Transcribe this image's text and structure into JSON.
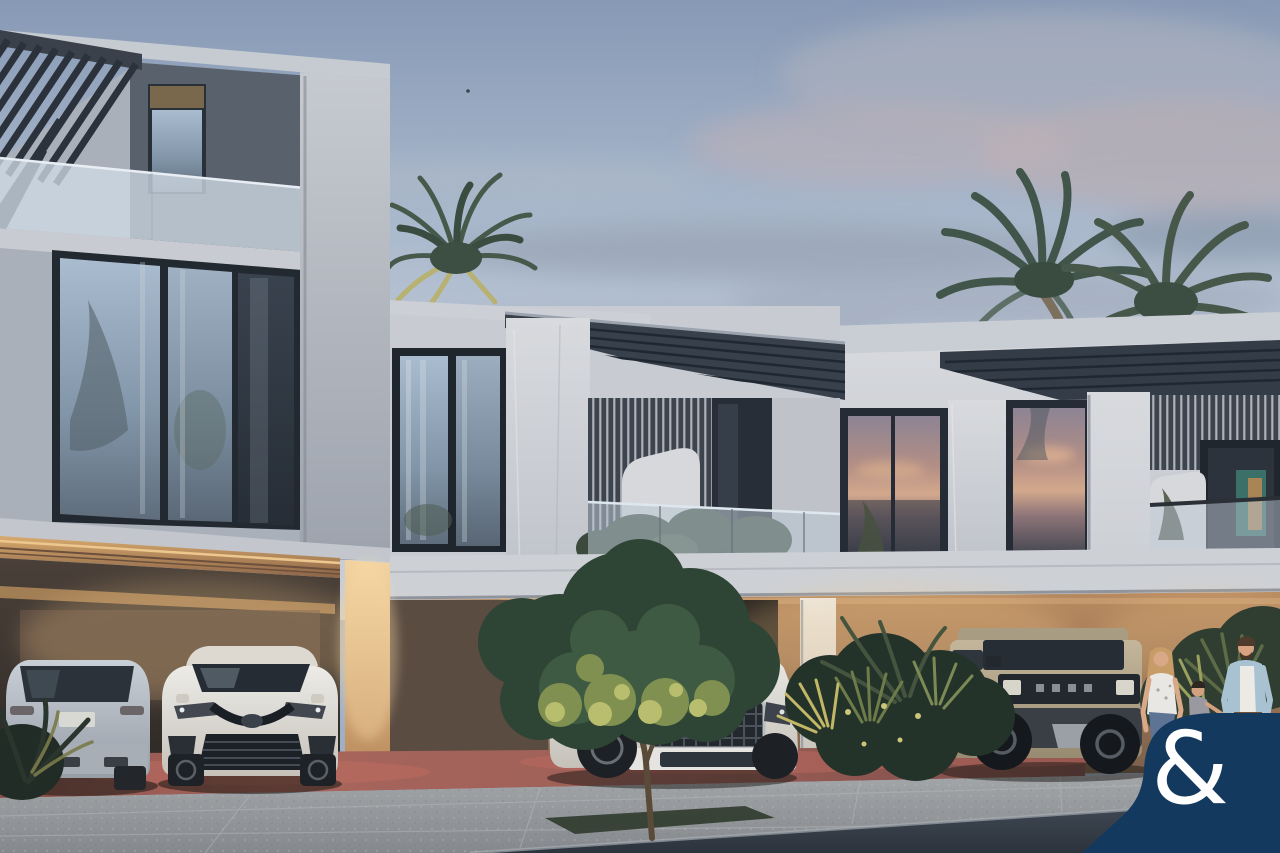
{
  "watermark": {
    "symbol": "&",
    "background_color": "#14395e",
    "symbol_color": "#ffffff"
  },
  "palette": {
    "sky_top": "#8799b5",
    "sky_horizon": "#c8cdd6",
    "cloud_grey": "#9aa5b6",
    "cloud_pink": "#c2b2b6",
    "facade_light": "#c6cad0",
    "facade_white": "#d6d8dc",
    "facade_dark_panel": "#59616d",
    "window_frame": "#20262e",
    "roof_canopy_dark": "#38404c",
    "glass_reflection": "#b9c6d2",
    "sunset_reflection": "#d3a88c",
    "warm_light": "#f0cc96",
    "warm_wall": "#a87f5e",
    "driveway_terracotta": "#96564f",
    "sidewalk_grey": "#9fa2a5",
    "road_dark": "#39424e",
    "palm_dark_green": "#3f5346",
    "palm_lit_yellow": "#c2bd72",
    "tree_dark_green": "#2e4434",
    "tree_lit_green": "#b9bd6e",
    "car_silver": "#b7bdc7",
    "car_white": "#dcd9d3",
    "car_tan": "#b3a68a",
    "denim_blue": "#5d7494",
    "jacket_blue": "#a8c2d2"
  }
}
